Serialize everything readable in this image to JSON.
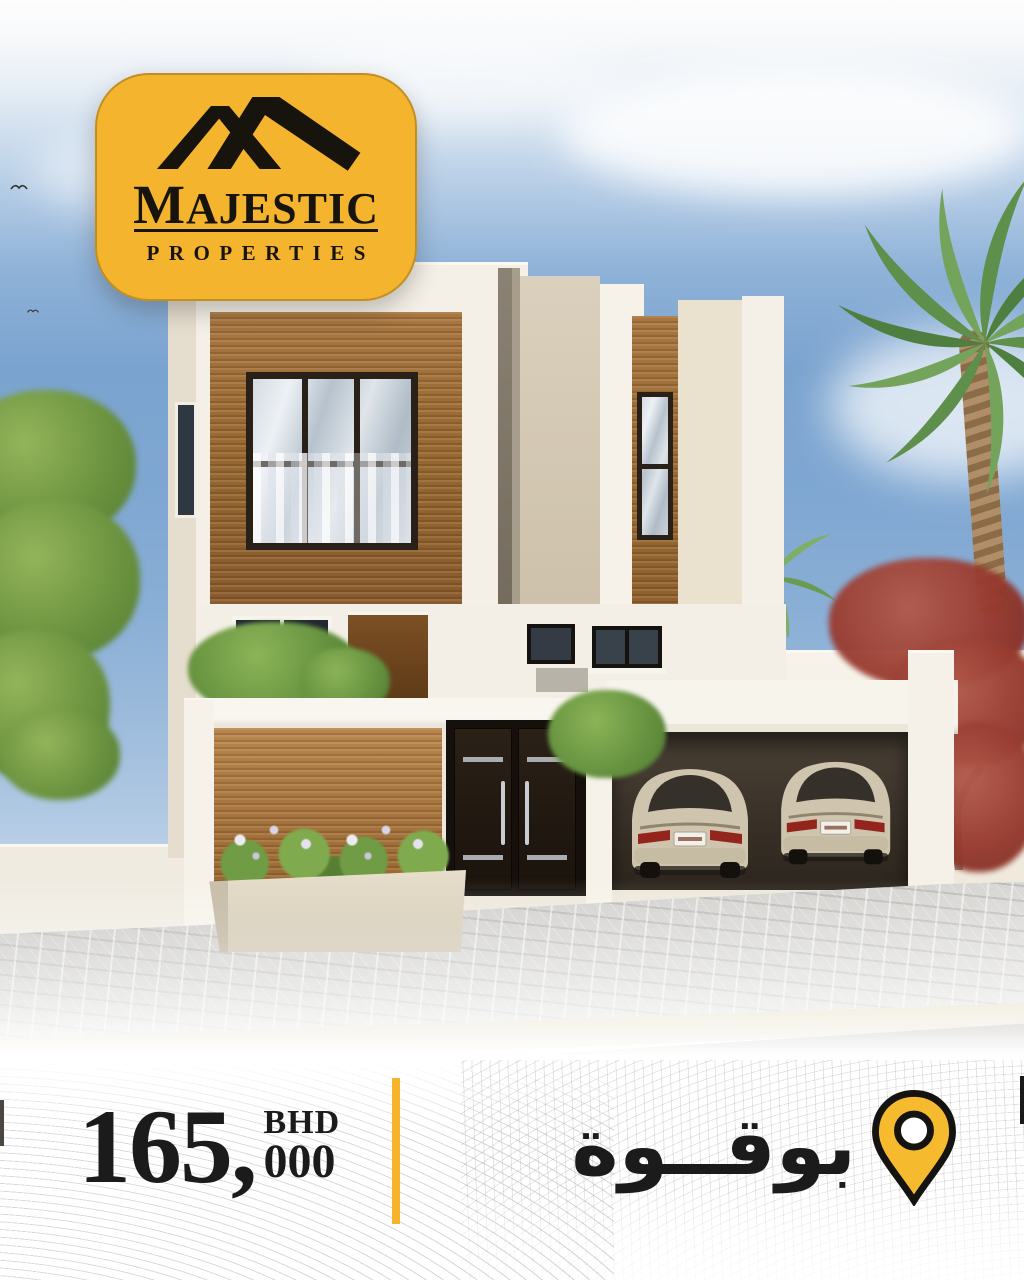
{
  "poster": {
    "brand": {
      "title": "MAJESTIC",
      "subtitle": "PROPERTIES"
    },
    "price": {
      "main": "165,",
      "thousands": "000",
      "currency": "BHD"
    },
    "location": {
      "name_ar": "بوقــوة"
    },
    "icons": {
      "logo": "roof-icon",
      "location": "location-pin-icon",
      "birds": "bird-icon"
    },
    "colors": {
      "brand_yellow": "#F4B42E",
      "divider_yellow": "#F6B32B",
      "pin_yellow": "#F6BA2F",
      "text_black": "#1B1B1B",
      "sky_blue": "#7AA3CF",
      "villa_cream": "#F3EFE6",
      "wood_brown": "#9A6A39",
      "tree_red": "#9C4036",
      "palm_green": "#6B9A52",
      "pavement_gray": "#CBCBC8"
    }
  }
}
